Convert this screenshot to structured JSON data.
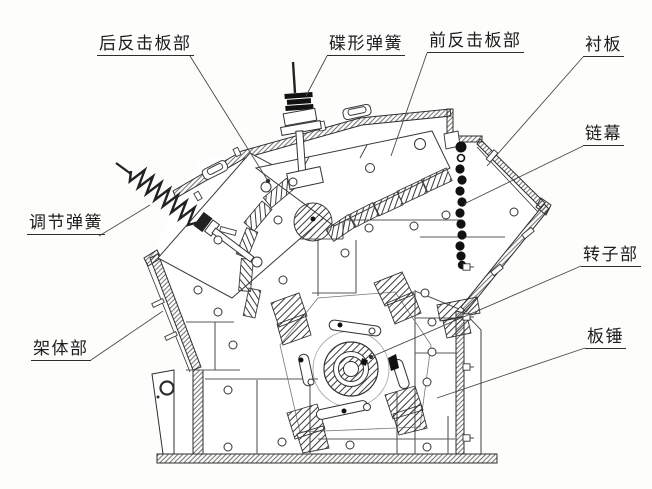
{
  "figure_labels": {
    "rear_impact_plate": "后反击板部",
    "disc_spring": "碟形弹簧",
    "front_impact_plate": "前反击板部",
    "liner_plate": "衬板",
    "chain_curtain": "链幕",
    "adjusting_spring": "调节弹簧",
    "frame_body": "架体部",
    "rotor_assembly": "转子部",
    "blow_bar": "板锤"
  },
  "colors": {
    "background": "#fdfdfc",
    "ink": "#2e2e2e",
    "leader_line": "#4a4a4a",
    "chain_bead": "#111111"
  }
}
